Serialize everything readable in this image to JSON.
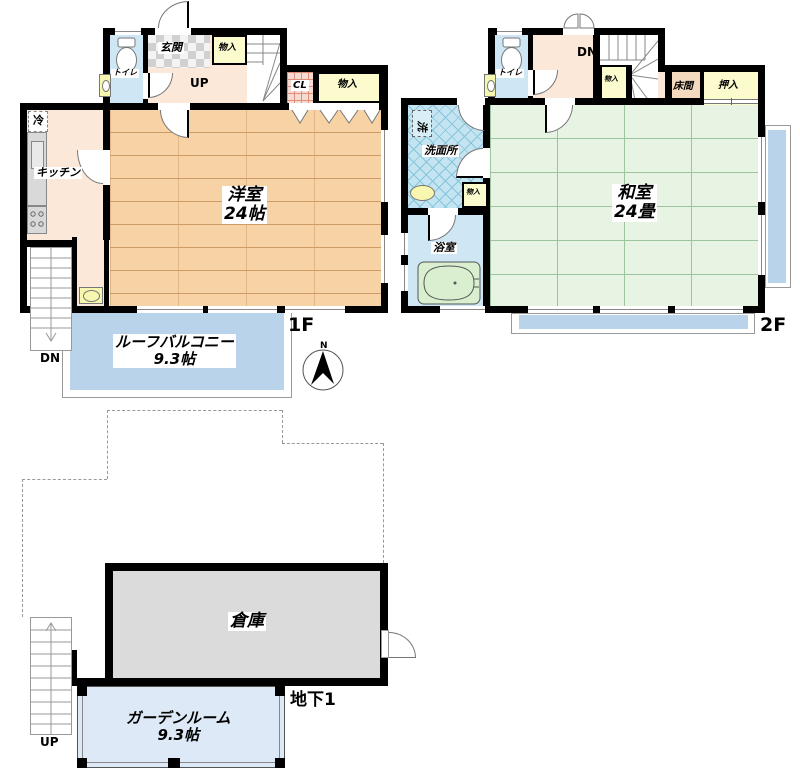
{
  "floor1": {
    "floor_label": "1F",
    "room_main": "洋室",
    "room_main_size": "24帖",
    "kitchen": "キッチン",
    "genkan": "玄関",
    "toilet": "トイレ",
    "closet_top": "物入",
    "closet_right": "物入",
    "closet_cl": "CL",
    "fridge": "冷",
    "stairs_up": "UP",
    "stairs_dn": "DN",
    "balcony": "ルーフバルコニー",
    "balcony_size": "9.3帖"
  },
  "floor2": {
    "floor_label": "2F",
    "room_main": "和室",
    "room_main_size": "24畳",
    "washroom": "洗面所",
    "laundry": "洗",
    "bathroom": "浴室",
    "toilet": "トイレ",
    "closet_hall": "物入",
    "closet_washroom": "物入",
    "tokonoma": "床間",
    "oshiire": "押入",
    "stairs_dn": "DN"
  },
  "basement": {
    "floor_label": "地下1",
    "warehouse": "倉庫",
    "garden_room": "ガーデンルーム",
    "garden_room_size": "9.3帖",
    "stairs_up": "UP"
  },
  "compass": {
    "north": "N"
  },
  "palette": {
    "wall": "#000000",
    "wood_floor": "#f6d2a4",
    "hall_peach": "#fce8d8",
    "tatami_green": "#e7f3e3",
    "water_blue": "#cfe7f5",
    "washroom_blue": "#c4e4f2",
    "closet_yellow": "#fbfbce",
    "balcony_blue": "#b9d3eb",
    "garden_blue": "#dde9f6",
    "warehouse_gray": "#dbdbdb",
    "tokonoma_tan": "#f3d9bd",
    "cl_pink": "#f6dbd2"
  }
}
